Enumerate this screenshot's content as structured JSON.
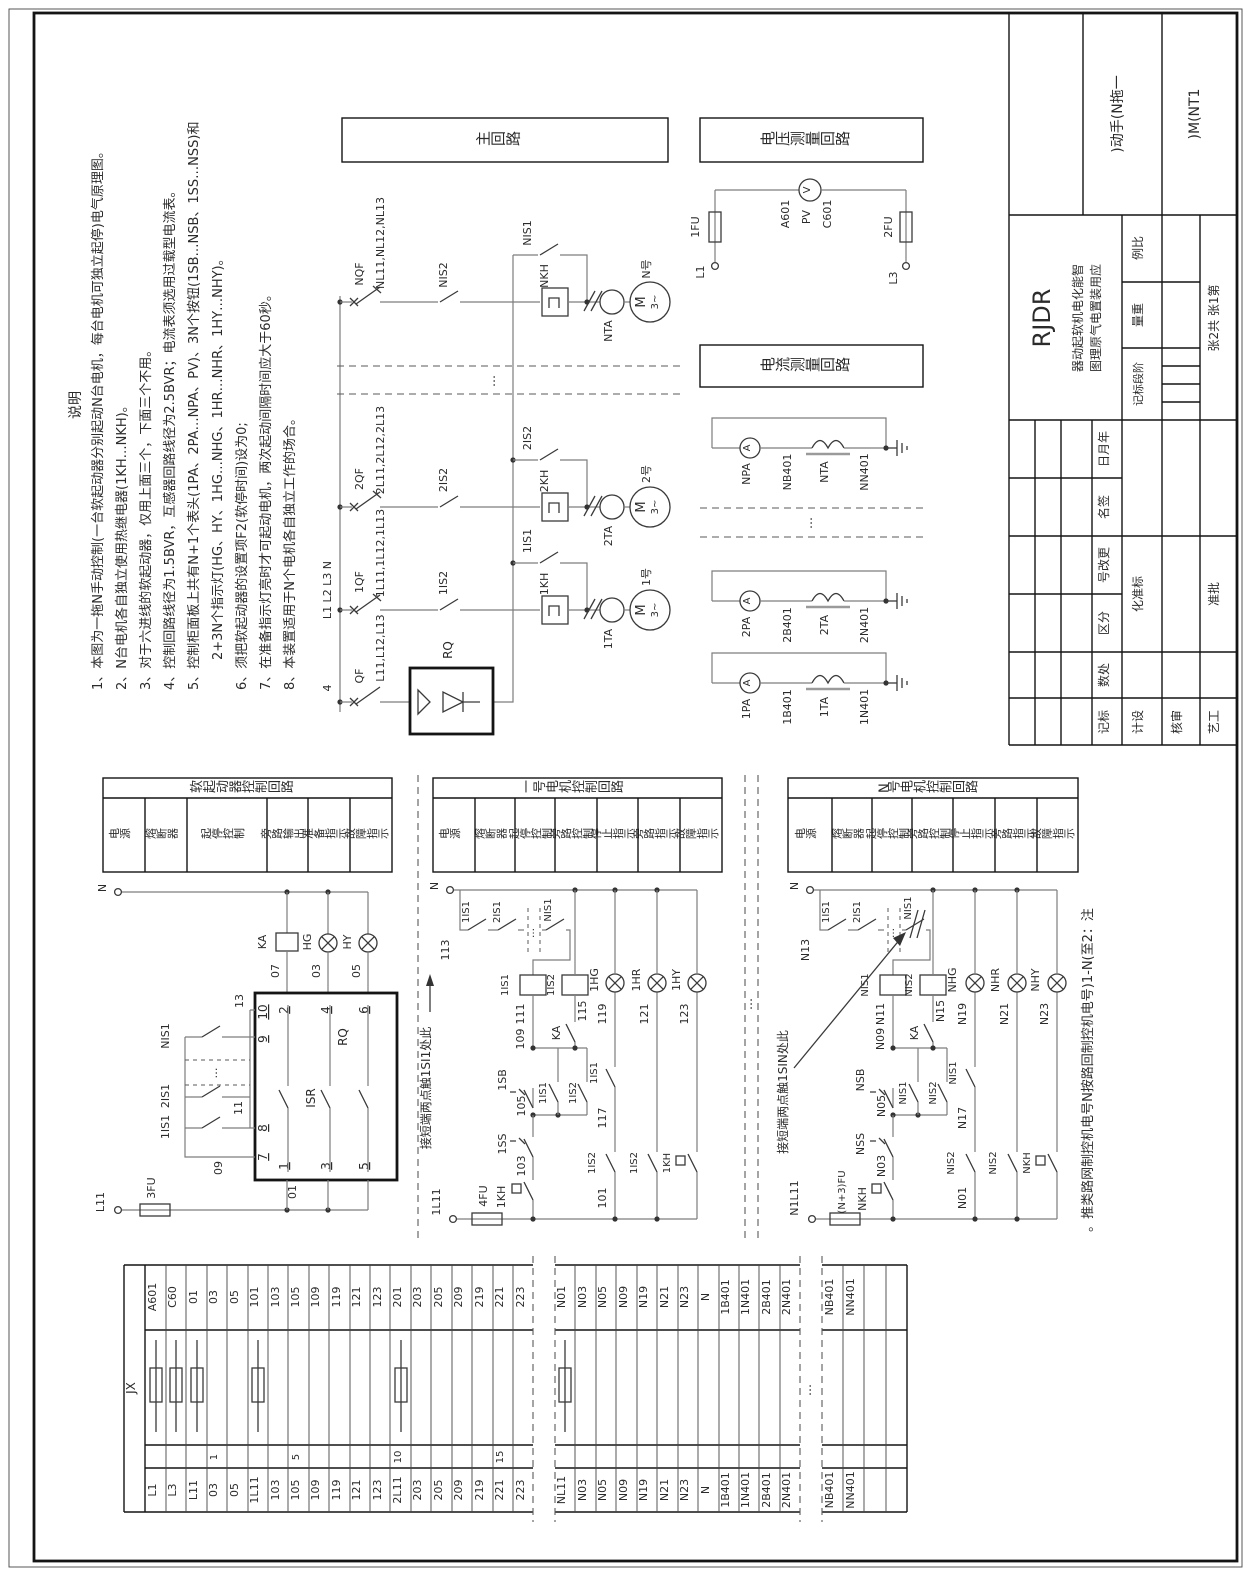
{
  "sym": {
    "ellipsis": "…"
  },
  "notes": {
    "title": "说明",
    "items": [
      "1、本图为一拖N手动控制(一台软起动器分别起动N台电机，每台电机可独立起停)电气原理图。",
      "2、N台电机各自独立使用热继电器(1KH…NKH)。",
      "3、对于六进线的软起动器，仅用上面三个，下面三个不用。",
      "4、控制回路线径为1.5BVR，互感器回路线径为2.5BVR；电流表须选用过载型电流表。",
      "5、控制柜面板上共有N+1个表头(1PA、2PA…NPA、PV)、3N个按钮(1SB…NSB、1SS…NSS)和",
      "2+3N个指示灯(HG、HY、1HG…NHG、1HR…NHR、1HY…NHY)。",
      "6、须把软起动器的设置项F2(软停时间)设为0;",
      "7、在准备指示灯亮时才可起动电机，两次起动间隔时间应大于60秒。",
      "8、本装置适用于N个电机各自独立工作的场合。"
    ]
  },
  "sections": {
    "main_title": "主回路",
    "voltage_title": "电压测量回路",
    "current_title": "电流测量回路"
  },
  "main": {
    "bus_label": "L1 L2 L3 N",
    "w4": "4",
    "branches": [
      {
        "qf": "NQF",
        "lines": "NL11,NL12,NL13",
        "is2": "NIS2",
        "kh": "NKH",
        "byp": "NIS1",
        "ta": "NTA",
        "no": "N号",
        "m": "M",
        "ph": "3~"
      },
      {
        "qf": "2QF",
        "lines": "2L11,2L12,2L13",
        "is2": "2IS2",
        "kh": "2KH",
        "byp": "2IS2",
        "ta": "2TA",
        "no": "2号",
        "m": "M",
        "ph": "3~"
      },
      {
        "qf": "1QF",
        "lines": "1L11,1L12,1L13",
        "is2": "1IS2",
        "kh": "1KH",
        "byp": "1IS1",
        "ta": "1TA",
        "no": "1号",
        "m": "M",
        "ph": "3~"
      }
    ],
    "rqf": {
      "qf": "QF",
      "lines": "L11,L12,L13",
      "rq": "RQ"
    }
  },
  "voltage": {
    "l1": "L1",
    "fu1": "1FU",
    "a": "A601",
    "pv": "PV",
    "v": "V",
    "c": "C601",
    "fu2": "2FU",
    "l3": "L3"
  },
  "current": {
    "loops": [
      {
        "pa": "NPA",
        "a": "A",
        "b": "NB401",
        "ta": "NTA",
        "n": "NN401"
      },
      {
        "pa": "2PA",
        "a": "A",
        "b": "2B401",
        "ta": "2TA",
        "n": "2N401"
      },
      {
        "pa": "1PA",
        "a": "A",
        "b": "1B401",
        "ta": "1TA",
        "n": "1N401"
      }
    ]
  },
  "groups": [
    {
      "title": "软起动器控制回路",
      "cols": [
        "电源",
        "熔断器",
        "起停控制",
        "旁路输出",
        "准备指示",
        "故障指示"
      ]
    },
    {
      "title": "一号电机控制回路",
      "cols": [
        "电源",
        "熔断器",
        "起停控制",
        "旁路控制",
        "停止指示",
        "旁路指示",
        "故障指示"
      ]
    },
    {
      "title": "N号电机控制回路",
      "cols": [
        "电源",
        "熔断器",
        "起停控制",
        "旁路控制",
        "停止指示",
        "旁路指示",
        "故障指示"
      ]
    }
  ],
  "ss": {
    "n": "N",
    "l11": "L11",
    "fu": "3FU",
    "w01": "01",
    "ka": "KA",
    "hg": "HG",
    "hy": "HY",
    "w07": "07",
    "w03": "03",
    "w05": "05",
    "rq": "RQ",
    "isr": "ISR",
    "t1": "1",
    "t2": "2",
    "t3": "3",
    "t4": "4",
    "t5": "5",
    "t6": "6",
    "t7": "7",
    "t8": "8",
    "t9": "9",
    "t10": "10",
    "w09": "09",
    "w11": "11",
    "w13": "13",
    "c1": "1IS1",
    "c2": "2IS1",
    "cn": "NIS1"
  },
  "m1": {
    "n": "N",
    "w113": "113",
    "b1": "1IS1",
    "b2": "2IS1",
    "bn": "NIS1",
    "coil1": "1IS1",
    "coil2": "1IS2",
    "w111": "111",
    "w115": "115",
    "ka": "KA",
    "hg": "1HG",
    "hr": "1HR",
    "hy": "1HY",
    "w119": "119",
    "w121": "121",
    "w123": "123",
    "w109": "109",
    "sb": "1SB",
    "ss": "1SS",
    "w105": "105",
    "w103": "103",
    "kh": "1KH",
    "fu": "4FU",
    "src": "1L11",
    "w101": "101",
    "h1": "1IS1",
    "h2": "1IS2",
    "lc1": "1IS2",
    "w117": "117",
    "lc2": "1IS1",
    "lc3": "1IS2",
    "lc4": "1KH",
    "note": "此处1IS1触点两端短接"
  },
  "mn": {
    "n": "N",
    "w_n13": "N13",
    "b1": "1IS1",
    "b2": "2IS1",
    "bn": "NIS1",
    "coil1": "NIS1",
    "coil2": "NIS2",
    "n11": "N11",
    "n15": "N15",
    "ka": "KA",
    "hg": "NHG",
    "hr": "NHR",
    "hy": "NHY",
    "n19": "N19",
    "n21": "N21",
    "n23": "N23",
    "n09": "N09",
    "sb": "NSB",
    "ss": "NSS",
    "n05": "N05",
    "n03": "N03",
    "kh": "NKH",
    "fu": "(N+3)FU",
    "src": "N1L11",
    "n01": "N01",
    "h1": "NIS1",
    "h2": "NIS2",
    "lc1": "NIS2",
    "n17": "N17",
    "lc2": "NIS1",
    "lc3": "NIS2",
    "lc4": "NKH",
    "note": "此处NIS1触点两端短接",
    "extra_note": "注：2至(N-1)号电机控制回路按N号电机控制网路类推。"
  },
  "terminals": {
    "jx": "JX",
    "top": [
      "A601",
      "C60",
      "01",
      "03",
      "05",
      "101",
      "103",
      "105",
      "109",
      "119",
      "121",
      "123",
      "201",
      "203",
      "205",
      "209",
      "219",
      "221",
      "223",
      "N01",
      "N03",
      "N05",
      "N09",
      "N19",
      "N21",
      "N23",
      "N",
      "1B401",
      "1N401",
      "2B401",
      "2N401",
      "NB401",
      "NN401",
      "",
      ""
    ],
    "bottom": [
      "L1",
      "L3",
      "L11",
      "03",
      "05",
      "1L11",
      "103",
      "105",
      "109",
      "119",
      "121",
      "123",
      "2L11",
      "203",
      "205",
      "209",
      "219",
      "221",
      "223",
      "NL11",
      "N03",
      "N05",
      "N09",
      "N19",
      "N21",
      "N23",
      "N",
      "1B401",
      "1N401",
      "2B401",
      "2N401",
      "NB401",
      "NN401",
      "",
      ""
    ],
    "seq": [
      "1",
      "5",
      "10",
      "15"
    ]
  },
  "title_block": {
    "product": "RDJR",
    "sub1": "智能化电机软起动器",
    "sub2": "应用装置电气原理图",
    "variant": "一拖N(手动)",
    "code": "1TN(M)",
    "scale_label": "比例",
    "weight_label": "重量",
    "stage_label": "阶段标记",
    "sheet": "第1张  共2张",
    "date": "年月日",
    "sign": "签名",
    "change": "更改号",
    "zone": "分区",
    "count": "处数",
    "mark": "标记",
    "std": "标准化",
    "design": "设计",
    "check": "审核",
    "process": "工艺",
    "approve": "批准"
  }
}
